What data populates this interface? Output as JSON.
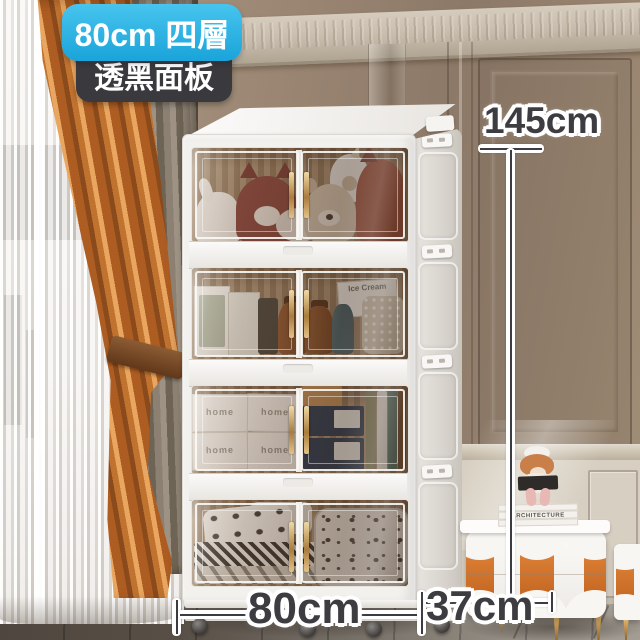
{
  "badges": {
    "size_label": "80cm 四層",
    "panel_label": "透黑面板"
  },
  "measurements": {
    "height_label": "145cm",
    "width_label": "80cm",
    "depth_label": "37cm"
  },
  "cabinet": {
    "tier_count": 4,
    "tiers": [
      {
        "name": "plush toys"
      },
      {
        "name": "bottles and cartons",
        "box_label": "Ice Cream"
      },
      {
        "name": "storage boxes",
        "box_label": "home"
      },
      {
        "name": "bedding"
      }
    ]
  },
  "nightstand": {
    "book_spine_label": "ARCHITECTURE"
  },
  "colors": {
    "badge_cyan": "#2bb3e6",
    "badge_dark": "#3a393d",
    "measure_text": "#3d3c41",
    "curtain_orange": "#c0732f",
    "cabinet_white": "#f3f1ee",
    "handle_gold": "#b98a4e"
  }
}
